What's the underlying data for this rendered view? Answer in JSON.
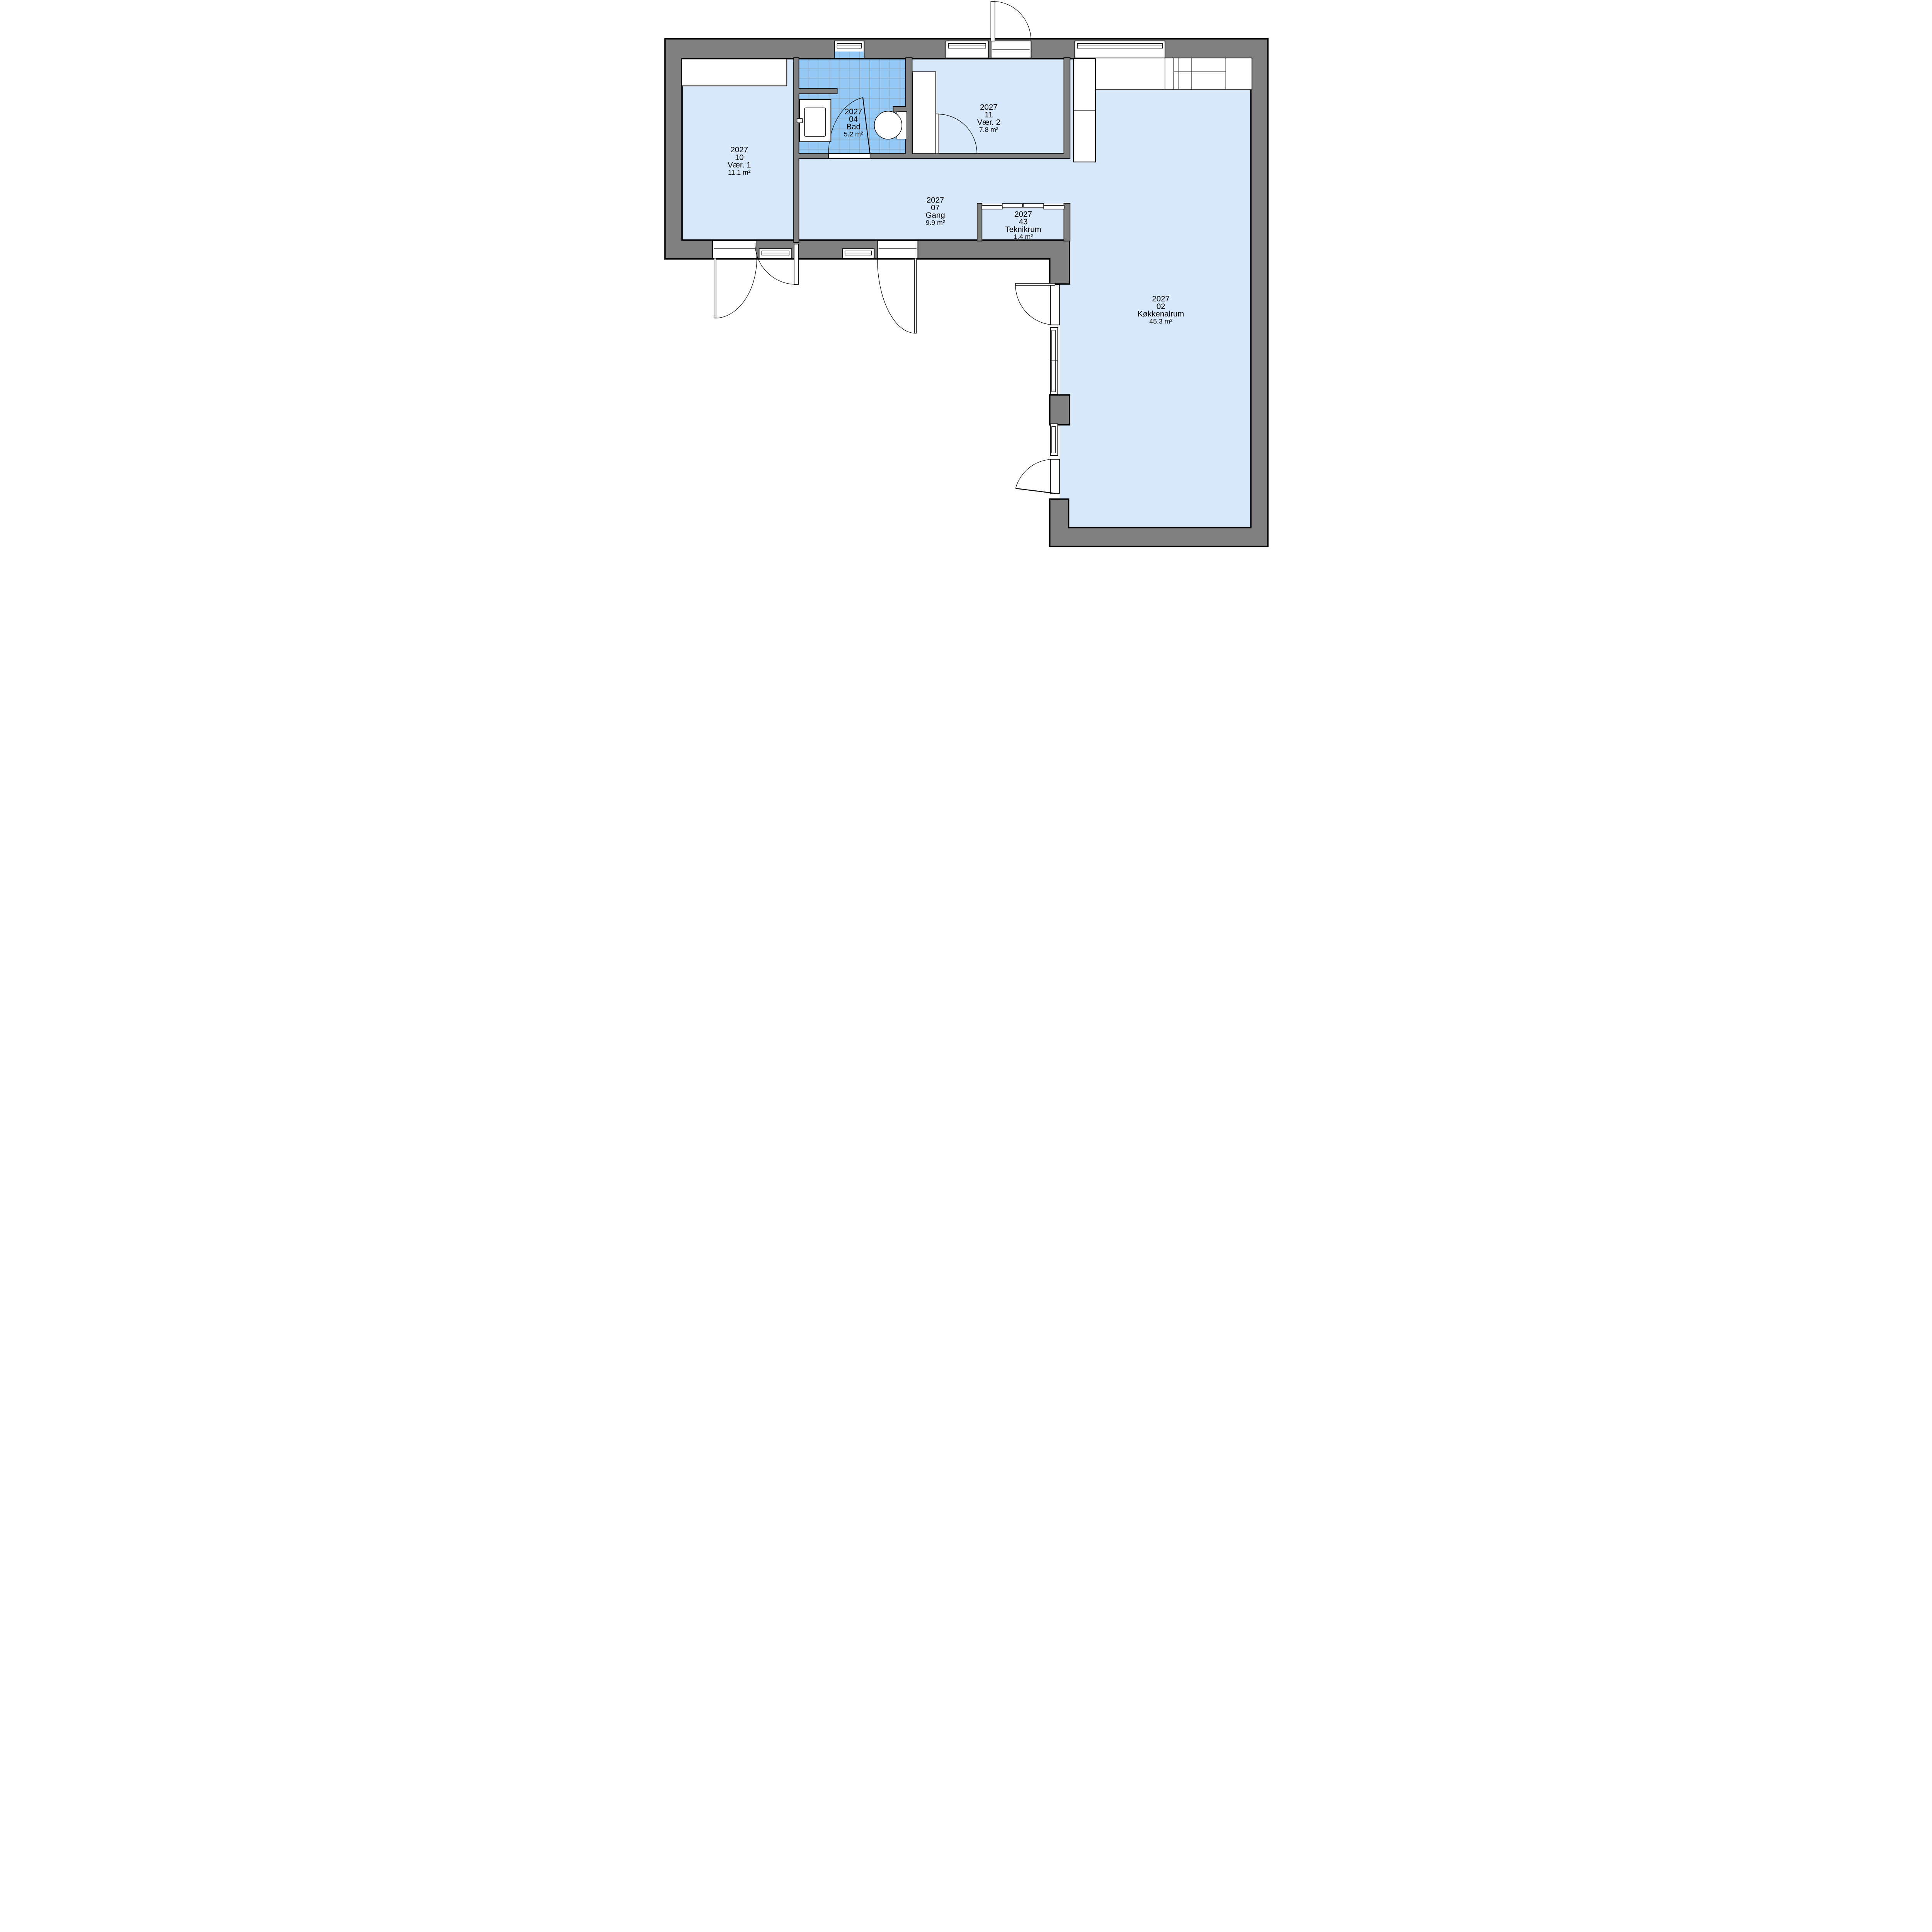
{
  "plan_title": "",
  "rooms": [
    {
      "project": "2027",
      "number": "10",
      "name": "Vær. 1",
      "area": "11.1 m²"
    },
    {
      "project": "2027",
      "number": "04",
      "name": "Bad",
      "area": "5.2 m²"
    },
    {
      "project": "2027",
      "number": "11",
      "name": "Vær. 2",
      "area": "7.8 m²"
    },
    {
      "project": "2027",
      "number": "07",
      "name": "Gang",
      "area": "9.9 m²"
    },
    {
      "project": "2027",
      "number": "43",
      "name": "Teknikrum",
      "area": "1.4 m²"
    },
    {
      "project": "2027",
      "number": "02",
      "name": "Køkkenalrum",
      "area": "45.3 m²"
    }
  ],
  "colors": {
    "floor": "#d7e8fb",
    "tile": "#93c9f4",
    "tile_grid": "#8b8b8b",
    "wall": "#808080",
    "outline": "#000000",
    "furniture": "#ffffff"
  }
}
